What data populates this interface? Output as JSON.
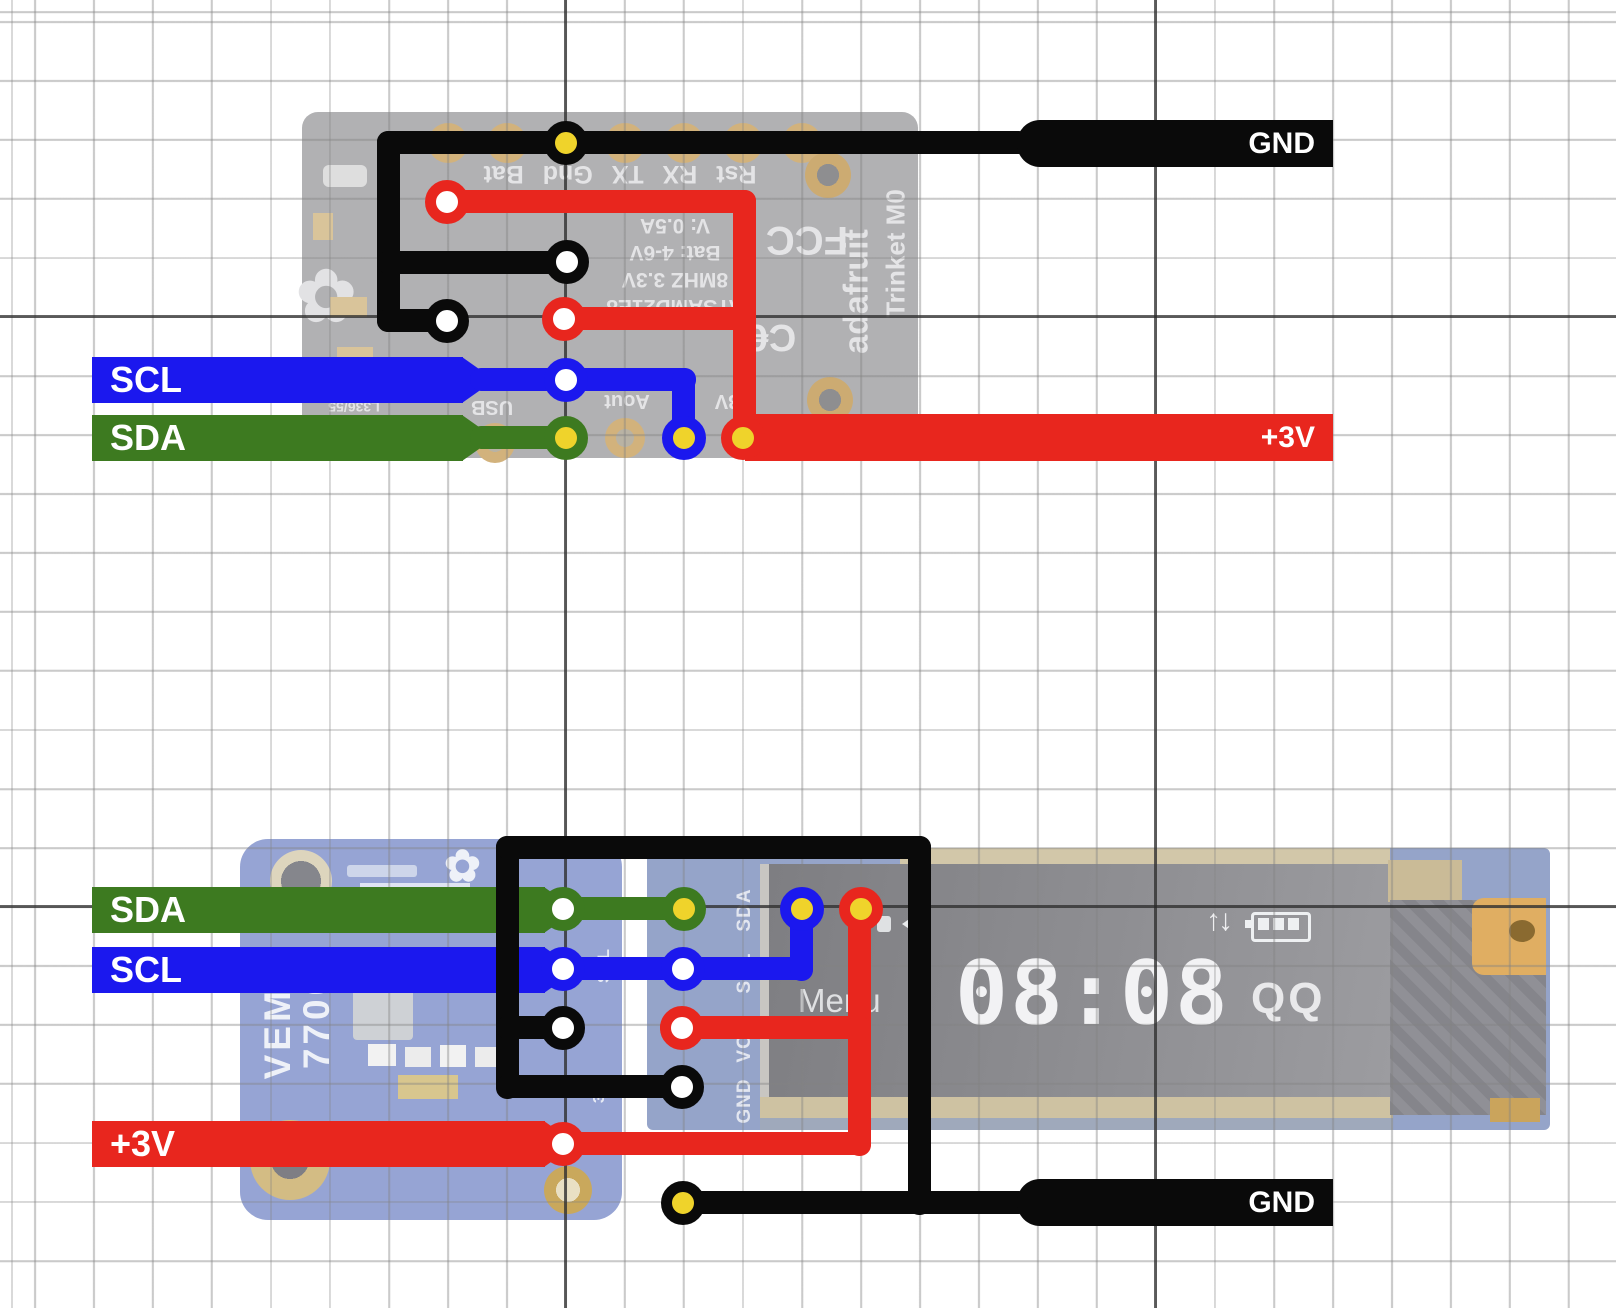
{
  "colors": {
    "wire-black": "#0a0a0a",
    "wire-red": "#e8261e",
    "wire-blue": "#1b18ee",
    "wire-green": "#3d7a20",
    "pad-yellow": "#efd32b"
  },
  "top": {
    "board": {
      "pin_row": "Rst RX TX Gnd Bat",
      "chip": "ATSAMD21E8",
      "spec_mhz": "8MHZ 3.3V",
      "spec_bat": "Bat: 4-6V",
      "spec_amp": "V: 0.5A",
      "brand": "adafruit",
      "model": "Trinket M0",
      "cert_fcc": "FCC",
      "cert_ce": "C€",
      "pin_usb": "USB",
      "pin_aout": "Aout",
      "pin_3v": "3V",
      "serial": "L336/55",
      "logo_icon": "✿"
    },
    "wires": {
      "gnd": "GND",
      "power": "+3V",
      "scl": "SCL",
      "sda": "SDA"
    }
  },
  "bottom": {
    "sensor": {
      "line1": "VEML",
      "line2": "7700",
      "silk_scl": "SCL",
      "silk_3vo": "3Vo",
      "logo_icon": "✿"
    },
    "oled": {
      "pins": [
        "SDA",
        "SCL",
        "VCC",
        "GND"
      ],
      "menu": "Menu",
      "time": "08:08",
      "status": "QQ",
      "arrows_icon": "↑↓"
    },
    "wires": {
      "sda": "SDA",
      "scl": "SCL",
      "power": "+3V",
      "gnd": "GND"
    }
  }
}
